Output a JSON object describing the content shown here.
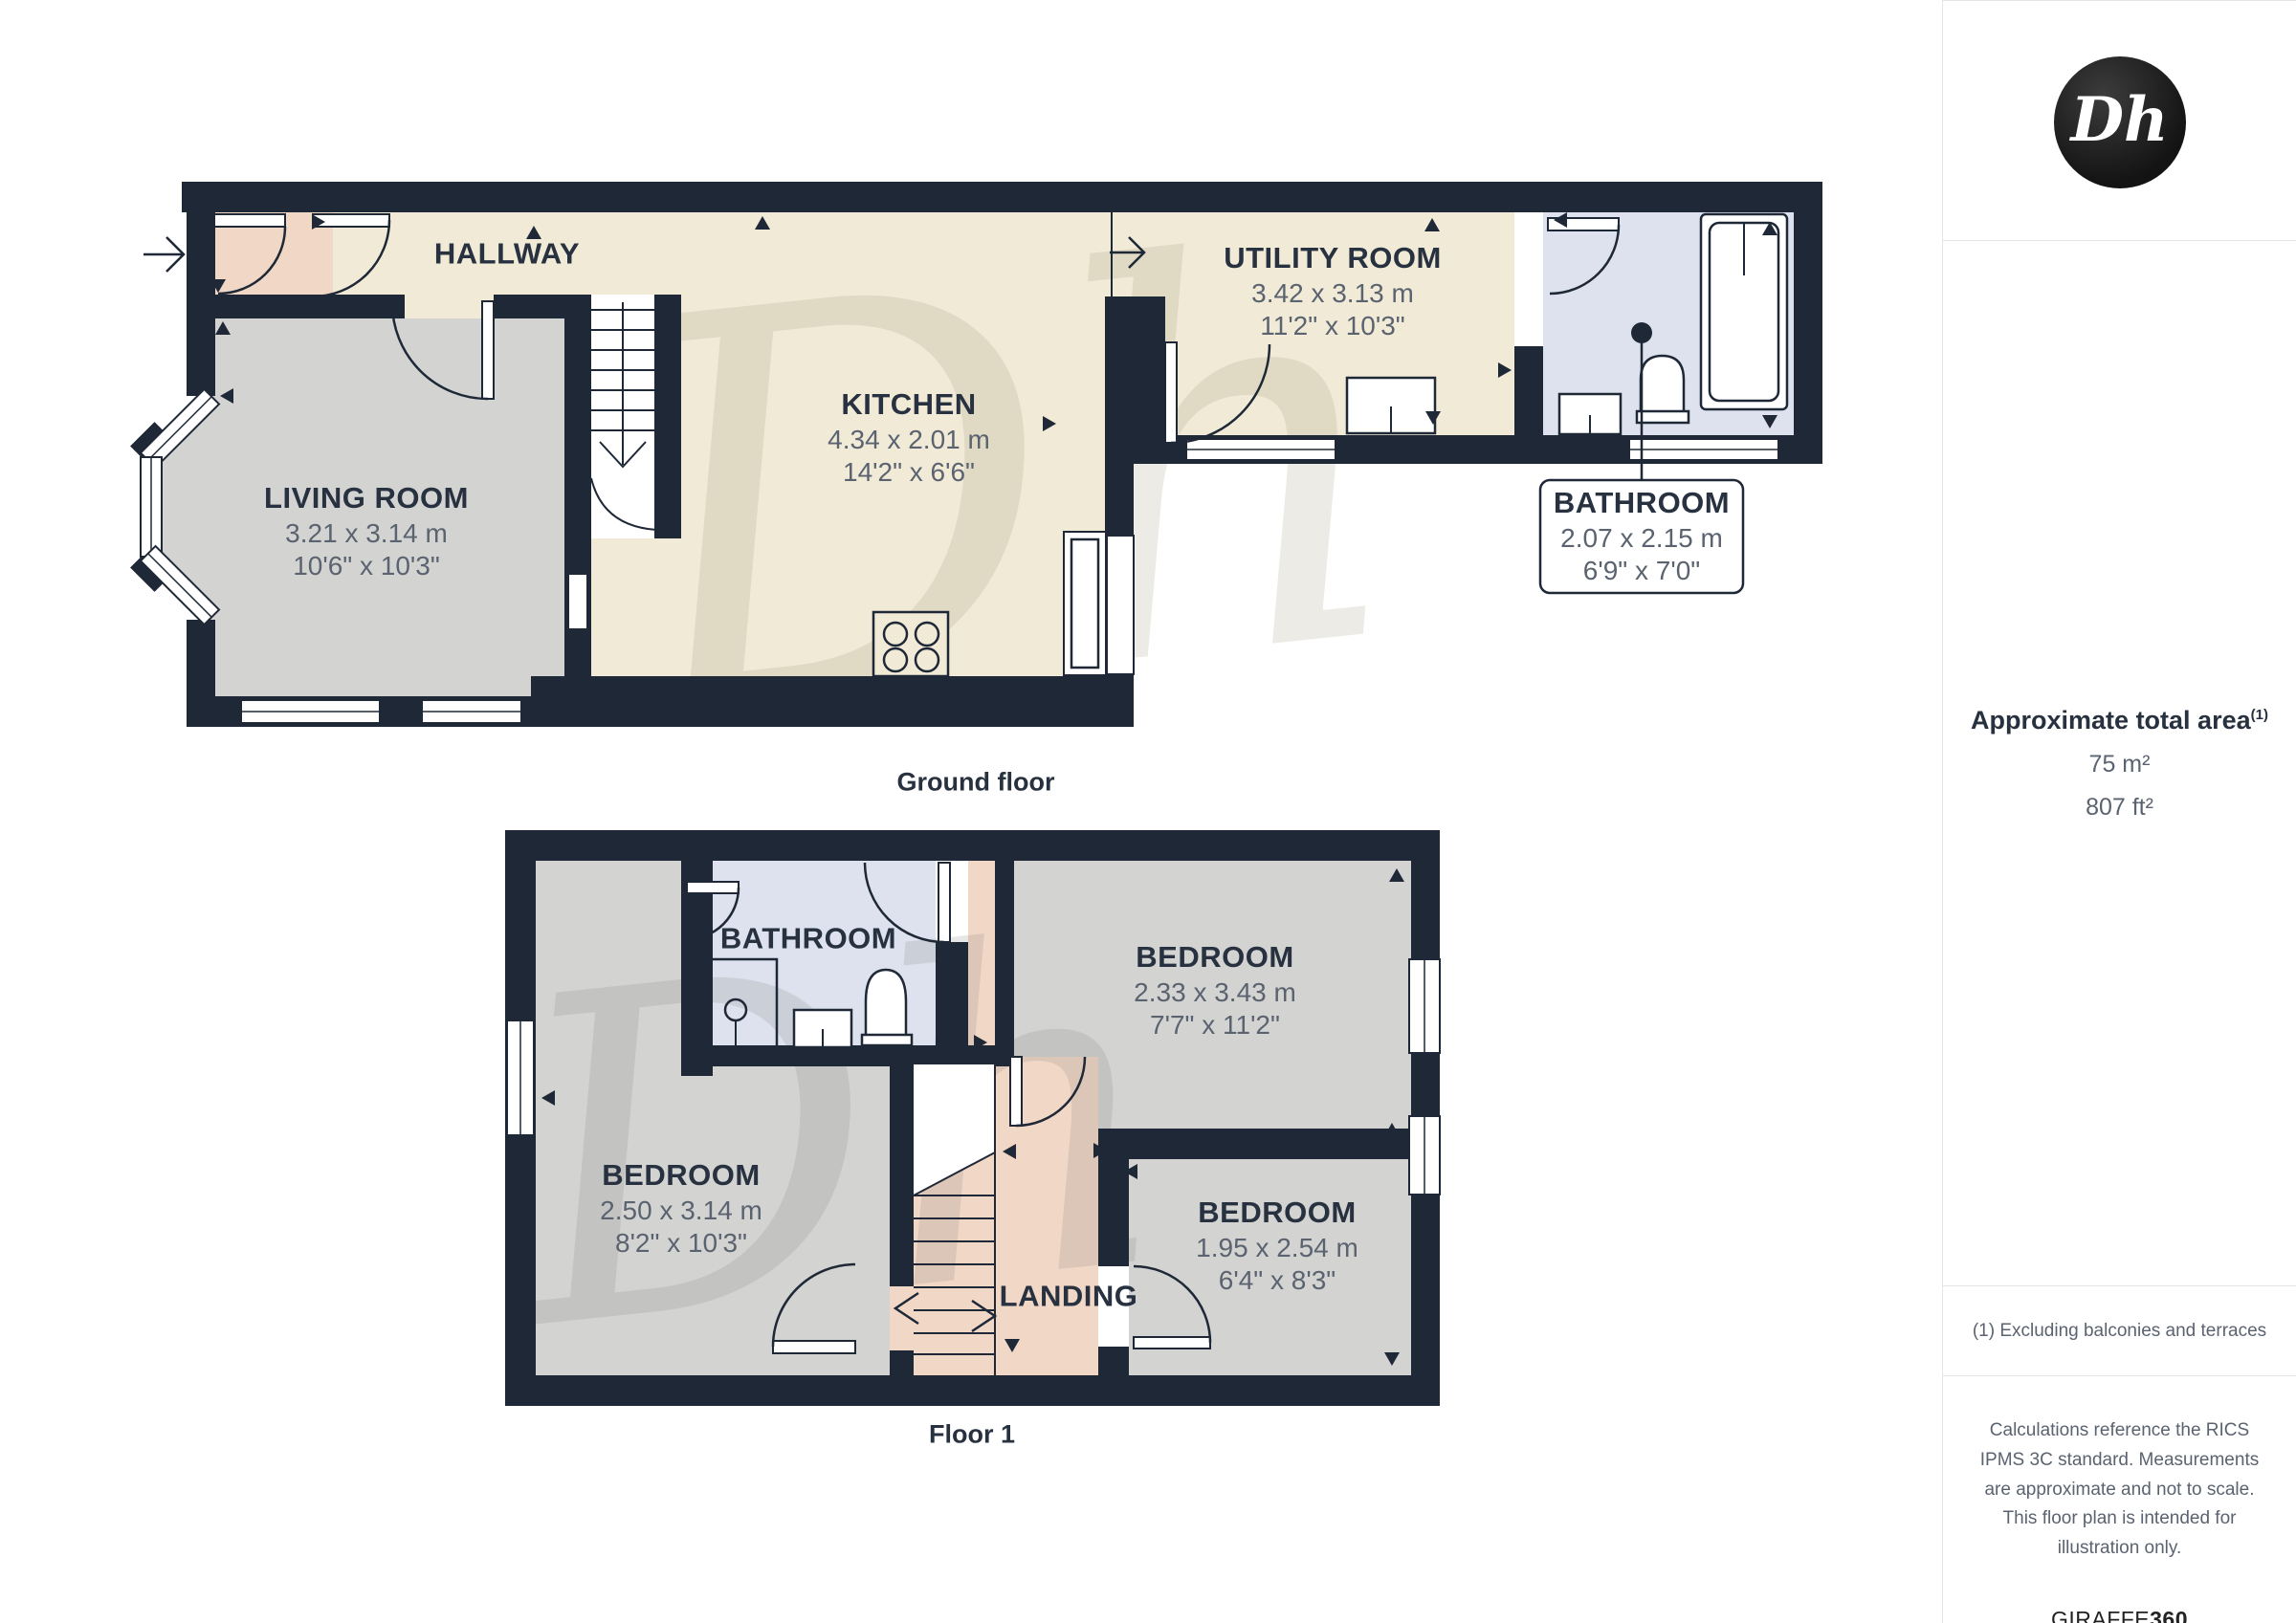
{
  "colors": {
    "wall": "#1e2836",
    "cream": "#f1ead7",
    "pink": "#f1d7c6",
    "floor_gray": "#d3d3d2",
    "bath_blue": "#dde2ee",
    "label_dark": "#27313f",
    "label_gray": "#5b6370",
    "line_light": "#e5e5e5"
  },
  "watermark": {
    "text": "Dh"
  },
  "ground_floor": {
    "caption": "Ground floor",
    "rooms": {
      "hallway": {
        "name": "HALLWAY"
      },
      "living_room": {
        "name": "LIVING ROOM",
        "metric": "3.21 x 3.14 m",
        "imperial": "10'6\" x 10'3\""
      },
      "kitchen": {
        "name": "KITCHEN",
        "metric": "4.34 x 2.01 m",
        "imperial": "14'2\" x 6'6\""
      },
      "utility_room": {
        "name": "UTILITY ROOM",
        "metric": "3.42 x 3.13 m",
        "imperial": "11'2\" x 10'3\""
      },
      "bathroom": {
        "name": "BATHROOM",
        "metric": "2.07 x 2.15 m",
        "imperial": "6'9\" x 7'0\""
      }
    }
  },
  "floor_1": {
    "caption": "Floor 1",
    "rooms": {
      "bathroom": {
        "name": "BATHROOM"
      },
      "bedroom_rear": {
        "name": "BEDROOM",
        "metric": "2.33 x 3.43 m",
        "imperial": "7'7\" x 11'2\""
      },
      "bedroom_front": {
        "name": "BEDROOM",
        "metric": "2.50 x 3.14 m",
        "imperial": "8'2\" x 10'3\""
      },
      "bedroom_small": {
        "name": "BEDROOM",
        "metric": "1.95 x 2.54 m",
        "imperial": "6'4\" x 8'3\""
      },
      "landing": {
        "name": "LANDING"
      }
    }
  },
  "sidebar": {
    "logo_text": "Dh",
    "area_title": "Approximate total area",
    "area_title_sup": "(1)",
    "area_metric": "75 m²",
    "area_imperial": "807 ft²",
    "footnote": "(1) Excluding balconies and terraces",
    "disclaimer": "Calculations reference the RICS IPMS 3C standard. Measurements are approximate and not to scale. This floor plan is intended for illustration only.",
    "brand_name": "GIRAFFE",
    "brand_suffix": "360"
  }
}
